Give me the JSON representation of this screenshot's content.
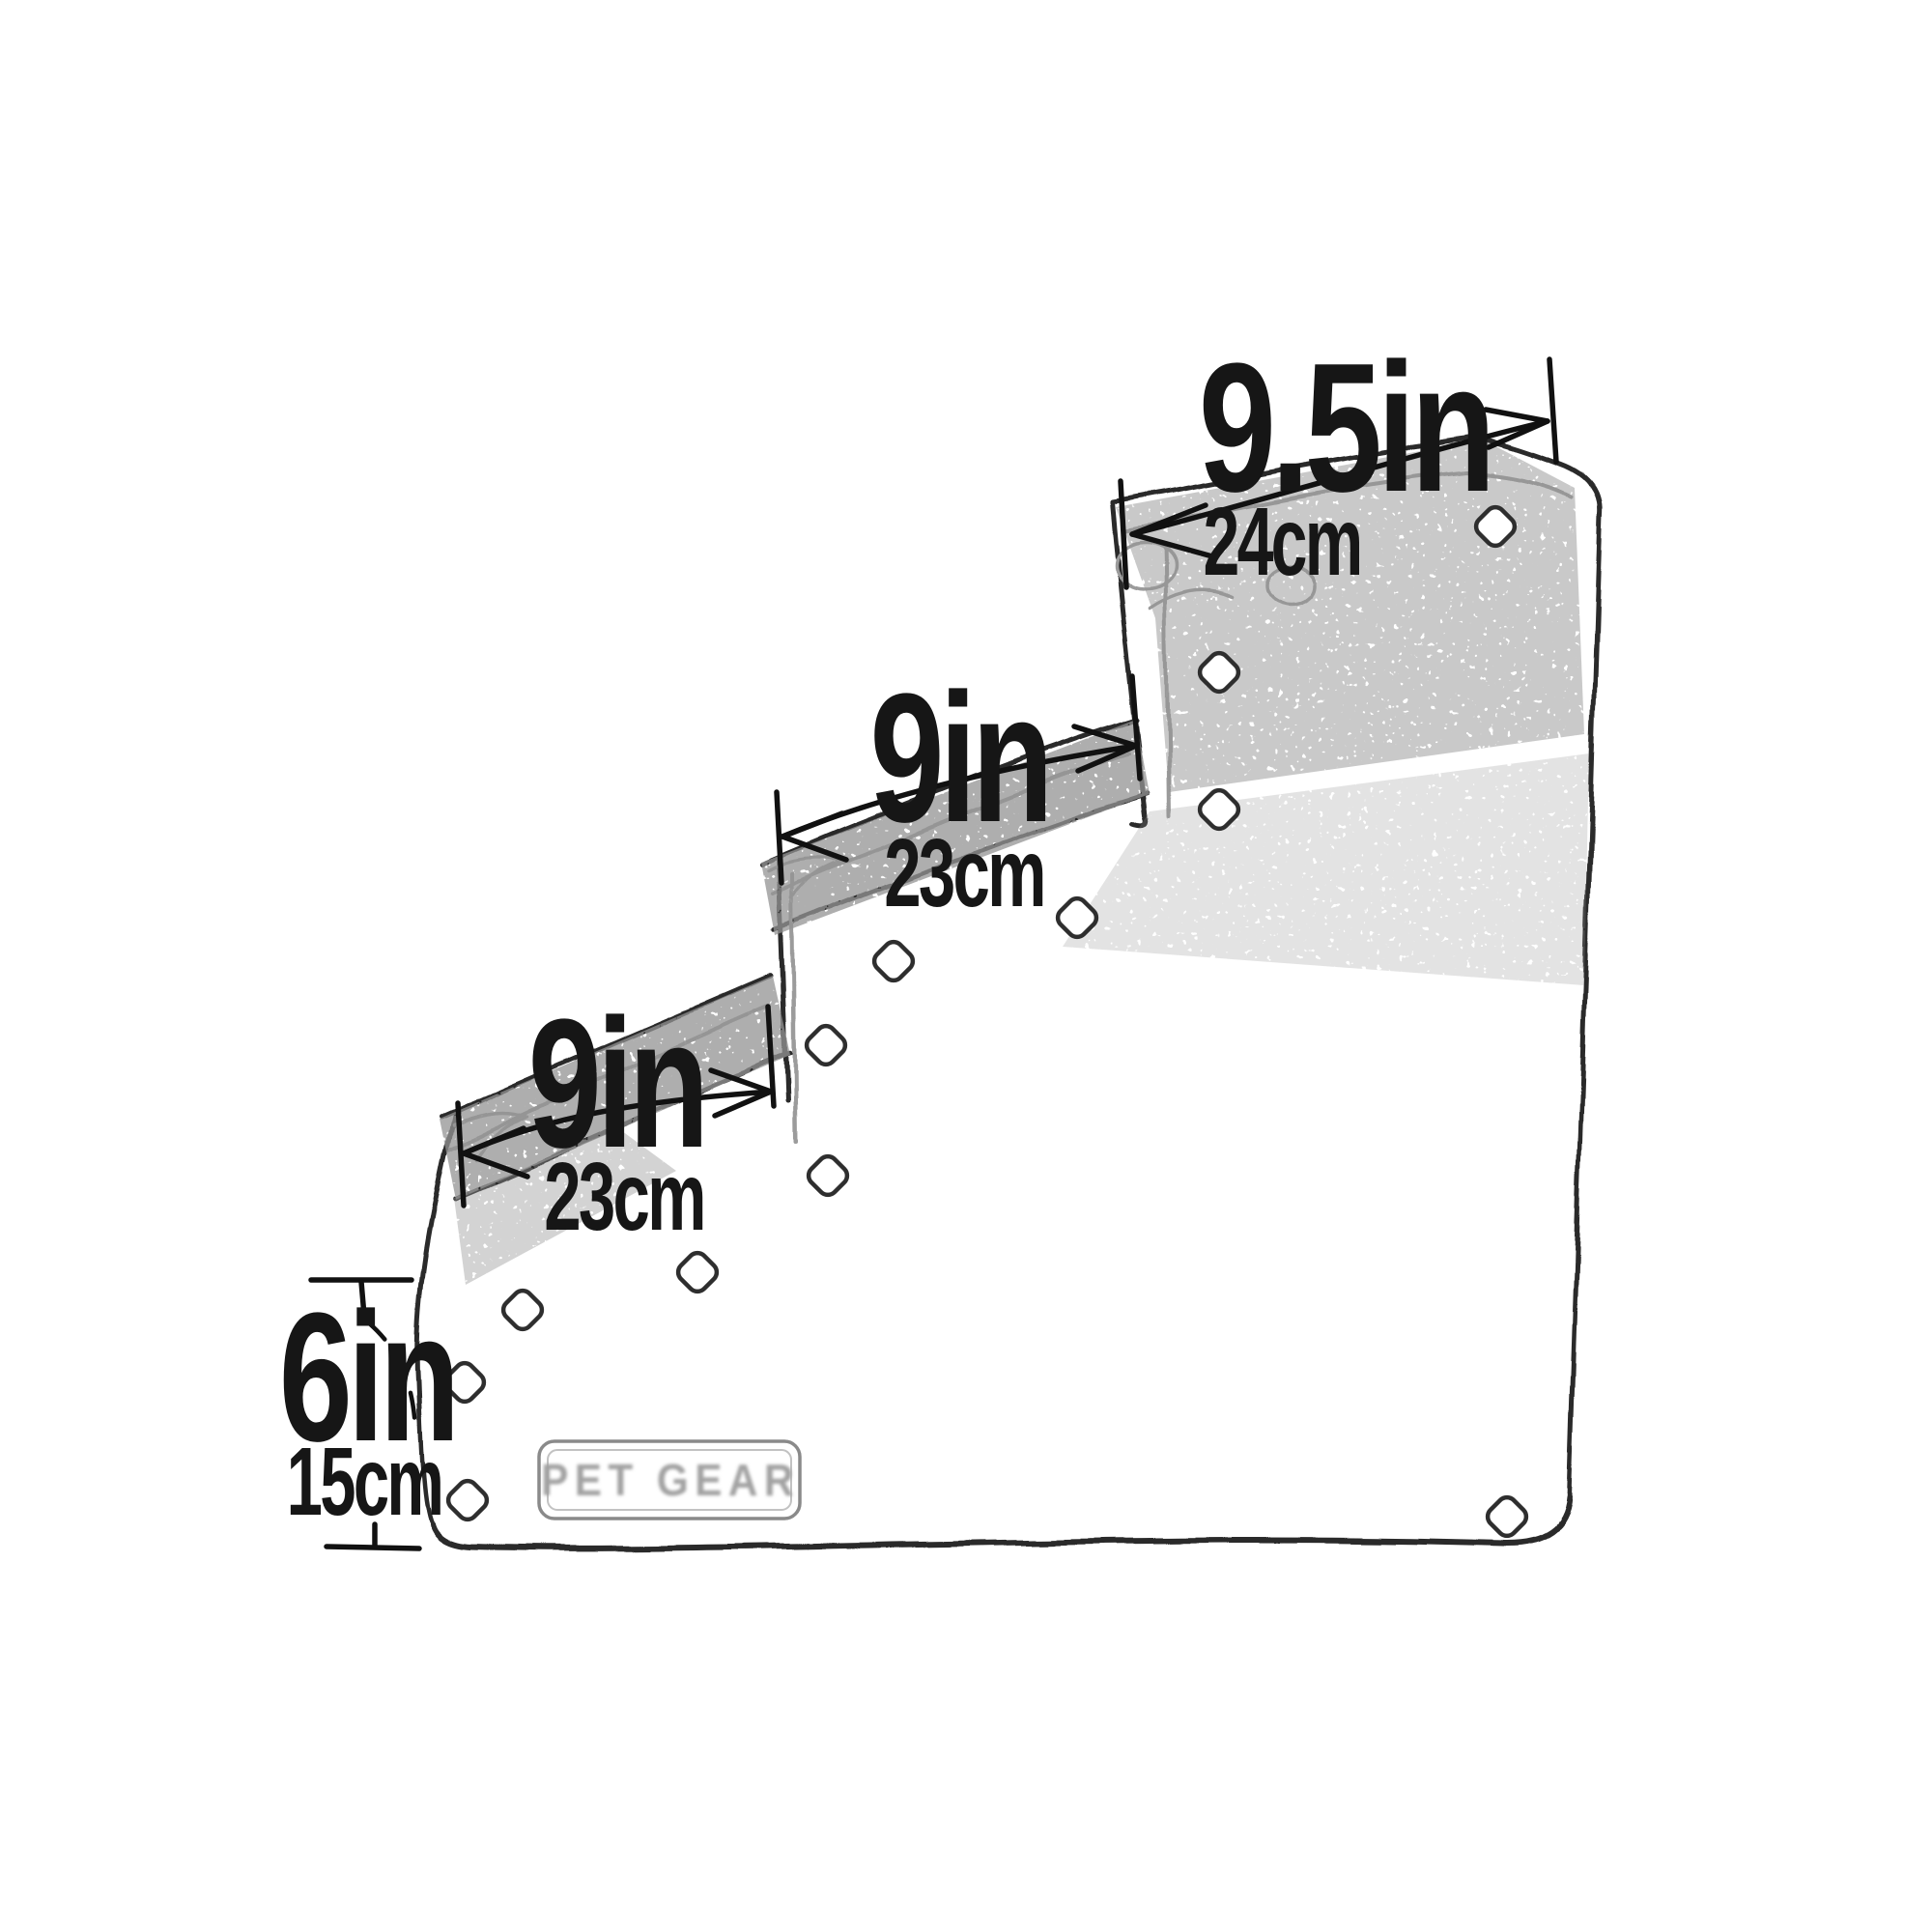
{
  "diagram": {
    "title": "Pet stairs dimension diagram",
    "top_step": {
      "inches": "9.5in",
      "centimeters": "24cm"
    },
    "middle_step": {
      "inches": "9in",
      "centimeters": "23cm"
    },
    "bottom_step": {
      "inches": "9in",
      "centimeters": "23cm"
    },
    "step_height": {
      "inches": "6in",
      "centimeters": "15cm"
    },
    "badge": {
      "text": "PET GEAR"
    },
    "colors": {
      "ink": "#1a1a1a",
      "sketch": "#909090",
      "background": "#ffffff"
    }
  }
}
